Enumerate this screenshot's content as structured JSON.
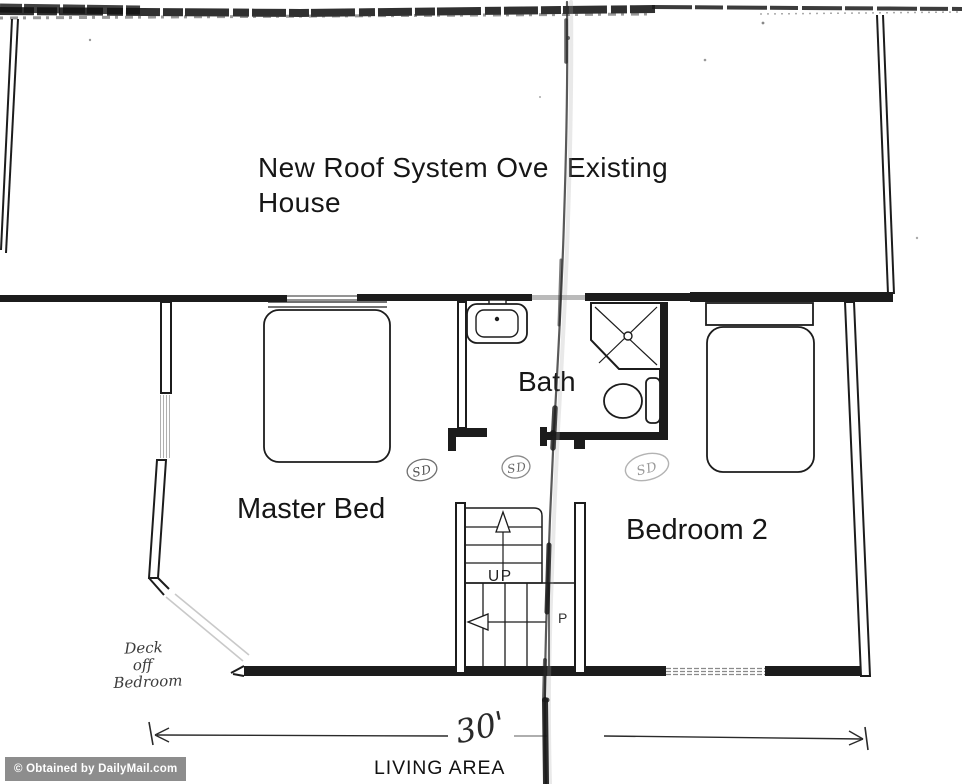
{
  "title": {
    "part1": "New Roof System Ove",
    "part2": "Existing",
    "line2": "House"
  },
  "rooms": {
    "master_bed": {
      "label": "Master Bed"
    },
    "bath": {
      "label": "Bath"
    },
    "bedroom_2": {
      "label": "Bedroom 2"
    }
  },
  "stairs": {
    "up_label": "UP",
    "lower_flight_label": "P"
  },
  "handwritten": {
    "deck_note_line1": "Deck",
    "deck_note_line2": "off",
    "deck_note_line3": "Bedroom",
    "sd_marks": {
      "sd1": "SD",
      "sd2": "SD",
      "sd3": "SD"
    },
    "dimension_value": "30'"
  },
  "dimension": {
    "area_label": "LIVING AREA"
  },
  "watermark": {
    "text": "© Obtained by DailyMail.com",
    "background": "#8d8d8d",
    "text_color": "#ffffff"
  },
  "colors": {
    "ink": "#1c1c1c",
    "pencil": "#8a8a8a",
    "paper": "#ffffff"
  }
}
